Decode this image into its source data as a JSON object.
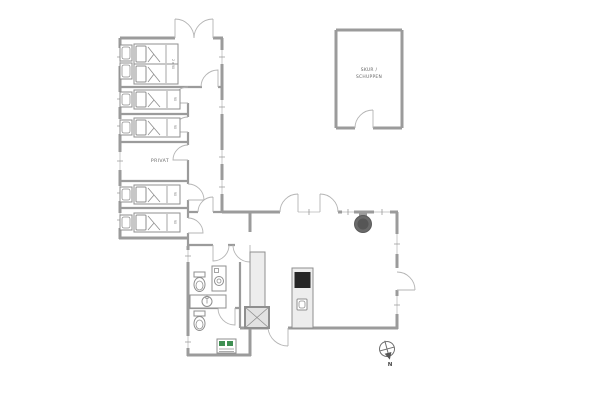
{
  "labels": {
    "privat_room": "PRIVAT",
    "shed_line1": "SKUR /",
    "shed_line2": "SCHUPPEN",
    "compass_north": "N",
    "double_bed_size": "2 x 90",
    "single_bed_size": "90"
  },
  "colors": {
    "background": "#ffffff",
    "wall": "#9b9b9b",
    "door": "#b4b4b4",
    "window_line": "#c8c8c8",
    "fixture": "#8f8f8f",
    "cabinet_fill": "#ededed",
    "shower_fill": "#e2e2e2",
    "stove_dark": "#262626",
    "wood_stove": "#6a6a6a",
    "appliance_green": "#3f8f52",
    "text": "#666666"
  },
  "icons": {
    "toilet": "toilet-top-view",
    "washbasin": "round-sink-in-counter",
    "washing_machine": "front-load-drum",
    "shower": "x-marked-square",
    "wood_stove": "filled-circle-on-wall",
    "kitchen_stove": "dark-rectangle",
    "kitchen_sink": "small-rounded-square",
    "compass": "circle-with-needle-arrow",
    "bed": "rect-with-pillow-and-fold",
    "door": "quarter-circle-arc"
  }
}
